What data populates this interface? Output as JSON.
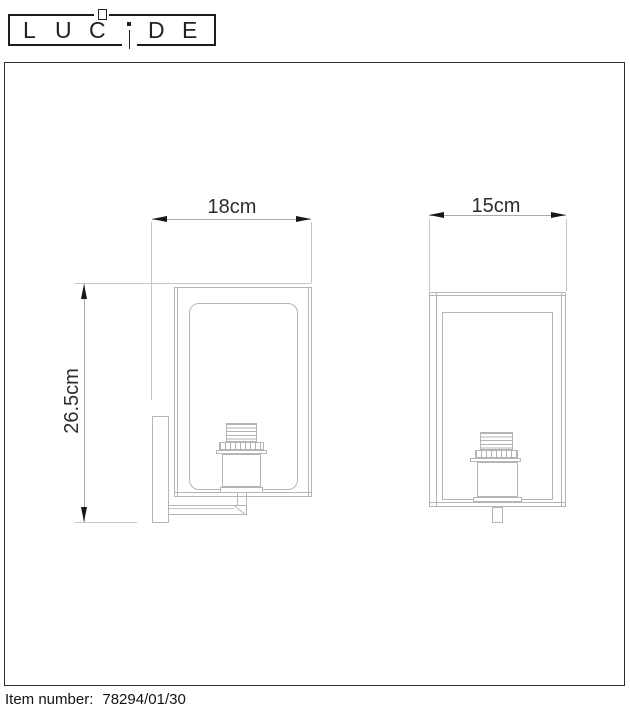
{
  "logo": {
    "text": "LUCIDE",
    "letters": [
      "L",
      "U",
      "C",
      "i",
      "D",
      "E"
    ]
  },
  "dimensions": {
    "front_width": "18cm",
    "front_height": "26.5cm",
    "side_width": "15cm"
  },
  "footer": {
    "item_label": "Item number:",
    "item_value": "78294/01/30"
  },
  "colors": {
    "ink": "#1c1c1c",
    "dimension_ink": "#2d2d2d",
    "drawing_line": "#b5b5b5",
    "extension_line": "#c6c6c6",
    "background": "#ffffff"
  }
}
